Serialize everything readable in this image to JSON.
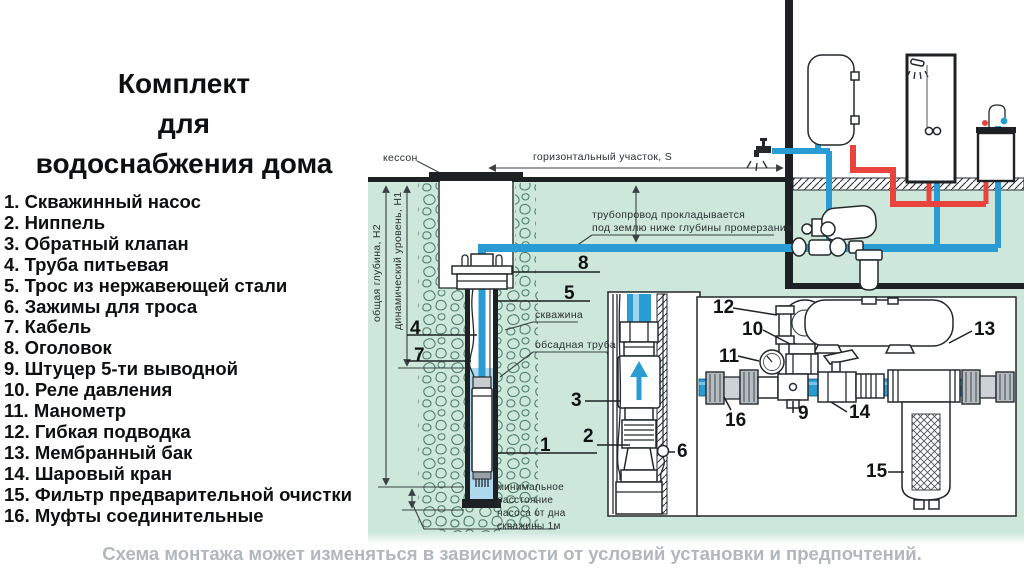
{
  "left_panel": {
    "title": "Комплект\nдля\nводоснабжения дома",
    "items": [
      "1. Скважинный насос",
      "2. Ниппель",
      "3. Обратный клапан",
      "4. Труба питьевая",
      "5. Трос из нержавеющей стали",
      "6. Зажимы для троса",
      "7. Кабель",
      "8. Оголовок",
      "9. Штуцер 5-ти выводной",
      "10. Реле давления",
      "11. Манометр",
      "12. Гибкая подводка",
      "13. Мембранный бак",
      "14. Шаровый кран",
      "15. Фильтр предварительной очистки",
      "16. Муфты соединительные"
    ]
  },
  "footer_note": "Схема монтажа может изменяться в зависимости от условий установки и предпочтений.",
  "diagram": {
    "labels": {
      "kesson": "кессон",
      "horizontal_section": "горизонтальный участок, S",
      "pipeline_note": "трубопровод прокладывается\nпод землю ниже глубины промерзания",
      "well": "скважина",
      "casing": "обсадная труба",
      "total_depth": "общая глубина, Н2",
      "dynamic_level": "динамический уровень, Н1",
      "min_distance": "минимальное\nрасстояние\nнасоса от дна\nскважины 1м"
    },
    "callouts": [
      "1",
      "2",
      "3",
      "4",
      "5",
      "6",
      "7",
      "8",
      "9",
      "10",
      "11",
      "12",
      "13",
      "14",
      "15",
      "16"
    ],
    "colors": {
      "ground": "#cde7db",
      "stone": "#53806f",
      "cold_pipe": "#2a9cd4",
      "hot_pipe": "#e8433c",
      "water": "#aed9ee",
      "line": "#1d2123",
      "note_text": "#b1b7ba"
    }
  }
}
